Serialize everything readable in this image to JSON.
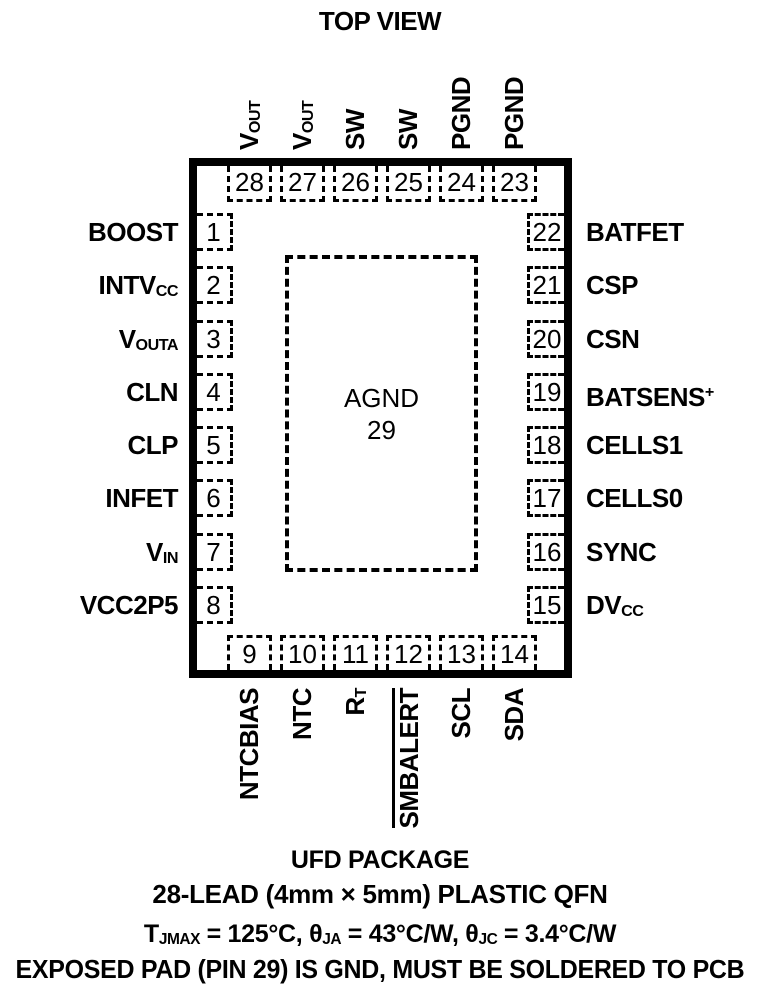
{
  "title": "TOP VIEW",
  "colors": {
    "ink": "#000000",
    "background": "#ffffff"
  },
  "chip": {
    "pad": {
      "label": "AGND",
      "number": "29"
    },
    "pins": {
      "top": [
        {
          "num": "28",
          "main": "V",
          "sub": "OUT"
        },
        {
          "num": "27",
          "main": "V",
          "sub": "OUT"
        },
        {
          "num": "26",
          "main": "SW"
        },
        {
          "num": "25",
          "main": "SW"
        },
        {
          "num": "24",
          "main": "PGND"
        },
        {
          "num": "23",
          "main": "PGND"
        }
      ],
      "left": [
        {
          "num": "1",
          "main": "BOOST"
        },
        {
          "num": "2",
          "main": "INTV",
          "sub": "CC"
        },
        {
          "num": "3",
          "main": "V",
          "sub": "OUTA"
        },
        {
          "num": "4",
          "main": "CLN"
        },
        {
          "num": "5",
          "main": "CLP"
        },
        {
          "num": "6",
          "main": "INFET"
        },
        {
          "num": "7",
          "main": "V",
          "sub": "IN"
        },
        {
          "num": "8",
          "main": "VCC2P5"
        }
      ],
      "right": [
        {
          "num": "22",
          "main": "BATFET"
        },
        {
          "num": "21",
          "main": "CSP"
        },
        {
          "num": "20",
          "main": "CSN"
        },
        {
          "num": "19",
          "main": "BATSENS",
          "sup": "+"
        },
        {
          "num": "18",
          "main": "CELLS1"
        },
        {
          "num": "17",
          "main": "CELLS0"
        },
        {
          "num": "16",
          "main": "SYNC"
        },
        {
          "num": "15",
          "main": "DV",
          "sub": "CC"
        }
      ],
      "bottom": [
        {
          "num": "9",
          "main": "NTCBIAS"
        },
        {
          "num": "10",
          "main": "NTC"
        },
        {
          "num": "11",
          "main": "R",
          "sub": "T"
        },
        {
          "num": "12",
          "main": "SMBALERT",
          "overline": true
        },
        {
          "num": "13",
          "main": "SCL"
        },
        {
          "num": "14",
          "main": "SDA"
        }
      ]
    }
  },
  "footer": {
    "package_name": "UFD PACKAGE",
    "package_desc": "28-LEAD (4mm × 5mm) PLASTIC QFN",
    "thermal": {
      "p1": "T",
      "p1sub": "JMAX",
      "p2": " = 125°C, ",
      "p3": "θ",
      "p3sub": "JA",
      "p4": " = 43°C/W, ",
      "p5": "θ",
      "p5sub": "JC",
      "p6": " = 3.4°C/W"
    },
    "note": "EXPOSED PAD (PIN 29) IS GND, MUST BE SOLDERED TO PCB"
  }
}
